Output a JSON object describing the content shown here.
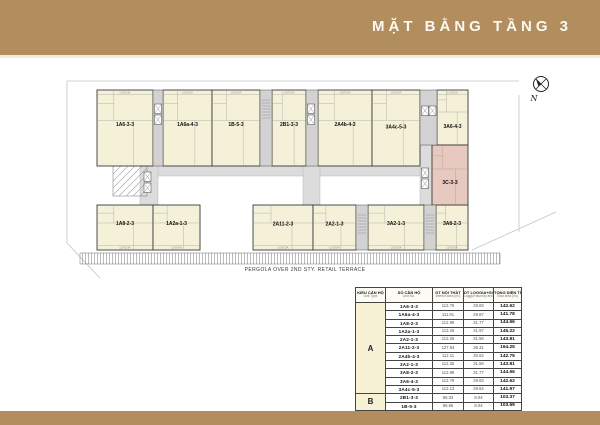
{
  "header": {
    "title": "MẶT BẰNG TẦNG 3"
  },
  "colors": {
    "banner_tan": "#b28e5e",
    "unit_fill": "#f5f1d8",
    "highlight_unit_fill": "#e7c9bf",
    "corridor_gray": "#dcdcdc",
    "type_column_bg": "#f7f2d6",
    "type_c_bg": "#bf9a62"
  },
  "plan": {
    "compass_label": "N",
    "pergola_caption": "PERGOLA OVER 2ND STY. RETAIL TERRACE",
    "loggia_label": "LOGGIA",
    "units": [
      {
        "label": "1A6-3-3"
      },
      {
        "label": "1A6a-4-3"
      },
      {
        "label": "1B-5-3"
      },
      {
        "label": "2B1-3-3"
      },
      {
        "label": "2A4b-4-3"
      },
      {
        "label": "3A4c-5-3"
      },
      {
        "label": "3A6-4-3"
      },
      {
        "label": "1A8-2-3"
      },
      {
        "label": "1A2a-1-3"
      },
      {
        "label": "2A11-2-3"
      },
      {
        "label": "2A2-1-3"
      },
      {
        "label": "3A2-1-3"
      },
      {
        "label": "3A8-2-3"
      },
      {
        "label": "3C-3-3",
        "highlighted": true
      }
    ]
  },
  "table": {
    "headers": [
      {
        "vn": "KIỂU CĂN HỘ",
        "en": "Unit Type"
      },
      {
        "vn": "SỐ CĂN HỘ",
        "en": "Unit No."
      },
      {
        "vn": "DT NỘI THẤT",
        "en": "Interior area (m²)"
      },
      {
        "vn": "DT LOGGIA+GIẶT",
        "en": "Loggia+laundry area (m²)"
      },
      {
        "vn": "TỔNG DIỆN TÍCH",
        "en": "Total area (m²)"
      }
    ],
    "groups": [
      {
        "type": "A",
        "rows": [
          [
            "1A6-3-3",
            "112.79",
            "29.83",
            "142.62"
          ],
          [
            "1A6a-4-3",
            "111.91",
            "29.87",
            "141.78"
          ],
          [
            "1A8-2-3",
            "112.89",
            "31.77",
            "144.66"
          ],
          [
            "1A2a-1-3",
            "113.25",
            "31.97",
            "145.22"
          ],
          [
            "2A2-1-3",
            "112.25",
            "31.56",
            "143.81"
          ],
          [
            "2A11-2-3",
            "127.94",
            "36.31",
            "164.25"
          ],
          [
            "2A4b-4-3",
            "112.11",
            "30.64",
            "142.75"
          ],
          [
            "3A2-1-3",
            "112.25",
            "31.56",
            "143.81"
          ],
          [
            "3A8-2-3",
            "112.89",
            "31.77",
            "144.66"
          ],
          [
            "3A6-4-3",
            "112.79",
            "29.83",
            "142.62"
          ],
          [
            "3A4c-5-3",
            "112.13",
            "29.84",
            "141.97"
          ]
        ]
      },
      {
        "type": "B",
        "rows": [
          [
            "2B1-3-3",
            "95.33",
            "8.04",
            "103.37"
          ],
          [
            "1B-5-3",
            "95.65",
            "8.04",
            "103.69"
          ]
        ]
      },
      {
        "type": "C",
        "rows": [
          [
            "3C-3-3",
            "98.97",
            "9.93",
            "108.90"
          ]
        ]
      }
    ]
  }
}
